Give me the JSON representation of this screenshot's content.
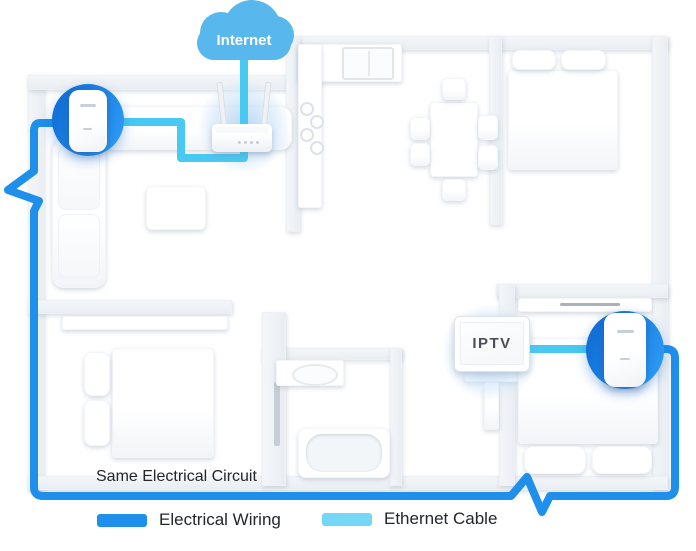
{
  "diagram": {
    "internet_label": "Internet",
    "iptv_label": "IPTV",
    "same_circuit_label": "Same Electrical Circuit"
  },
  "legend": {
    "electrical": {
      "label": "Electrical Wiring",
      "color": "#1E8FEA"
    },
    "ethernet": {
      "label": "Ethernet Cable",
      "color": "#74D7F6"
    }
  },
  "colors": {
    "electrical_wiring_line": "#1E8FEA",
    "ethernet_cable_line": "#47C9F1",
    "adapter_circle_blue": "#1478E0",
    "internet_cloud_blue": "#58B8ED"
  },
  "icons": {
    "cloud": "internet-cloud-icon",
    "router": "wifi-router-icon",
    "adapter": "powerline-adapter-icon",
    "tv": "iptv-screen-icon"
  }
}
